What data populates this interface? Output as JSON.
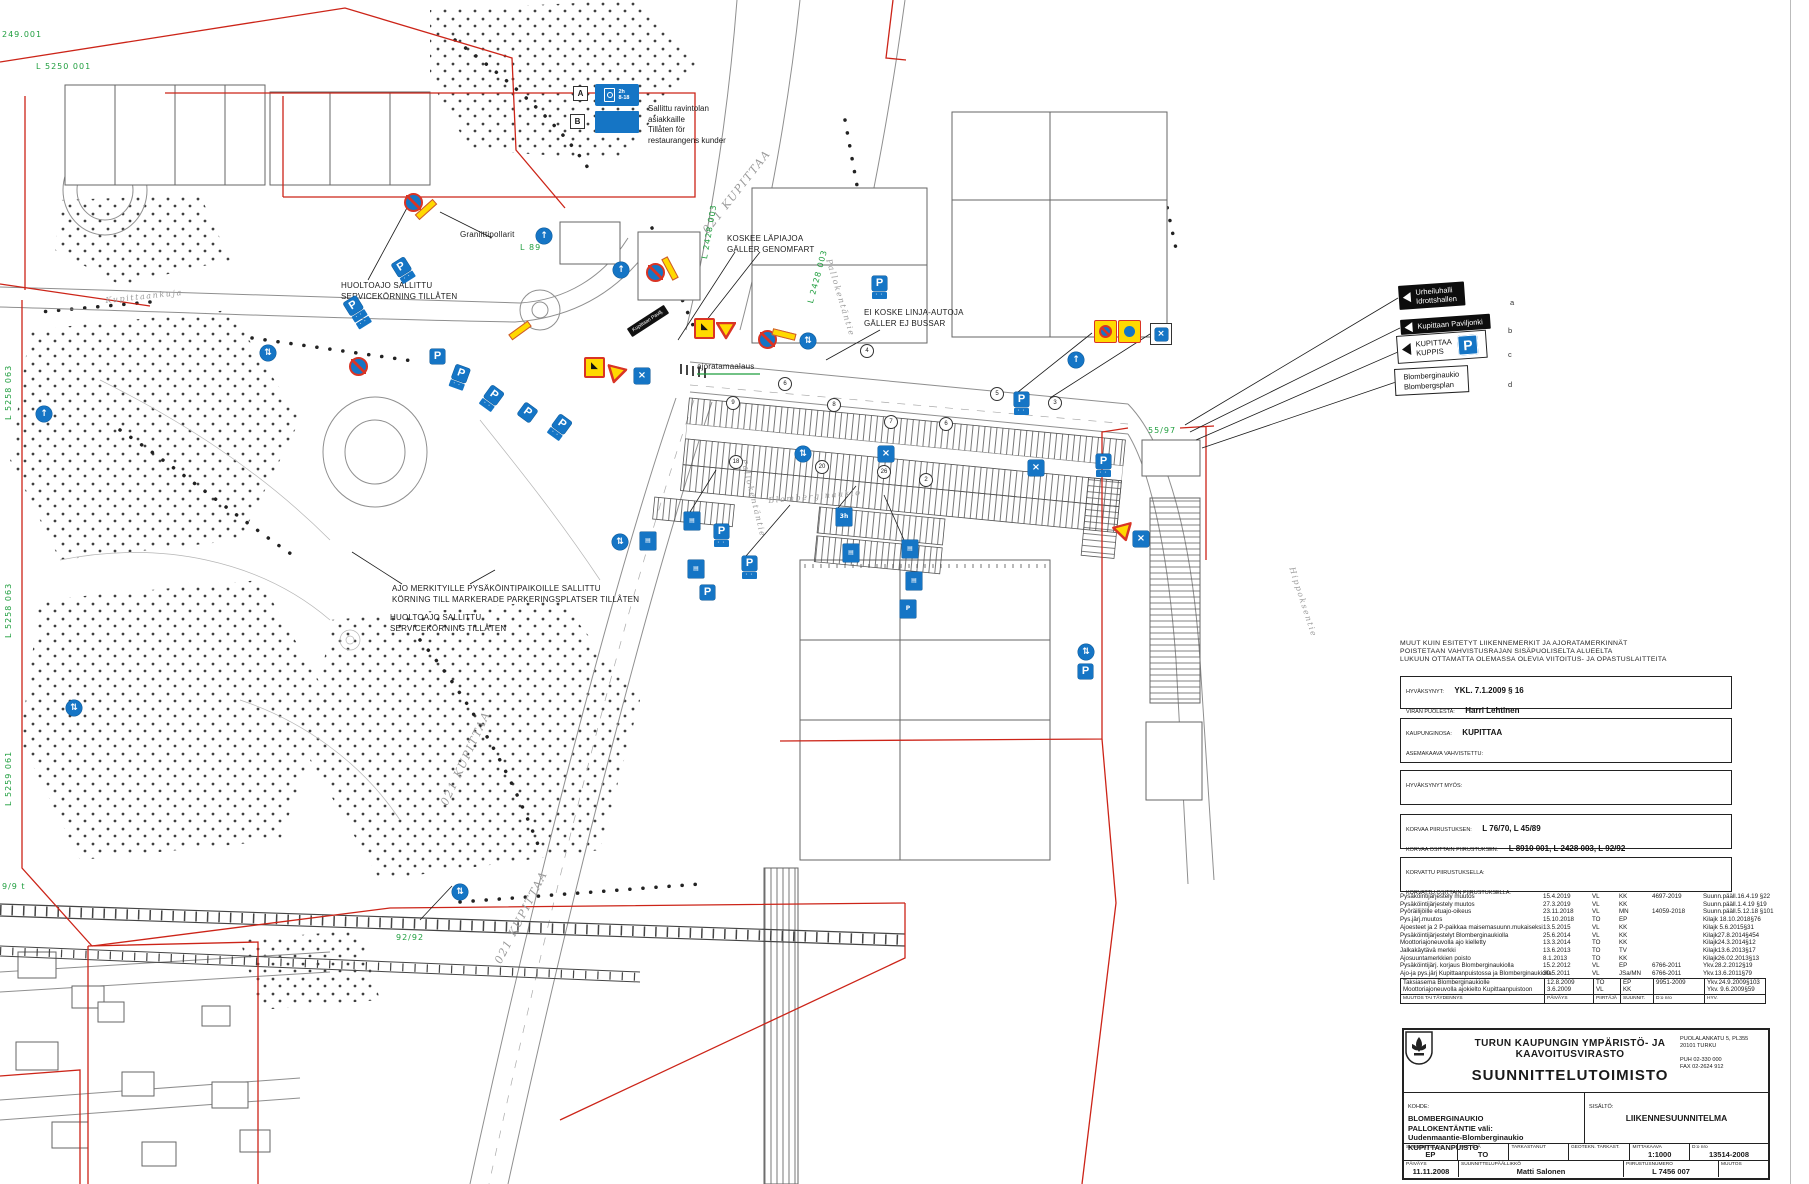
{
  "legend": {
    "a_letter": "A",
    "a_line1": "2h",
    "a_line2": "8-18",
    "b_letter": "B",
    "text": "Sallittu ravintolan\nasiakkaille\nTillåten för\nrestaurangens kunder"
  },
  "map": {
    "annotations": [
      {
        "text": "HUOLTOAJO SALLITTU\nSERVICEKÖRNING TILLÅTEN",
        "x": 341,
        "y": 281
      },
      {
        "text": "Graniittipollarit",
        "x": 460,
        "y": 230
      },
      {
        "text": "KOSKEE LÄPIAJOA\nGÄLLER GENOMFART",
        "x": 727,
        "y": 234
      },
      {
        "text": "EI KOSKE LINJA-AUTOJA\nGÄLLER EJ BUSSAR",
        "x": 864,
        "y": 308
      },
      {
        "text": "ajoratamaalaus",
        "x": 697,
        "y": 362
      },
      {
        "text": "AJO MERKITYILLE PYSÄKÖINTIPAIKOILLE SALLITTU\nKÖRNING TILL MARKERADE PARKERINGSPLATSER TILLÅTEN",
        "x": 392,
        "y": 584
      },
      {
        "text": "HUOLTOAJO SALLITTU\nSERVICEKÖRNING TILLÅTEN",
        "x": 390,
        "y": 613
      }
    ],
    "street_labels": [
      {
        "text": "Kupittaankuja",
        "x": 105,
        "y": 296,
        "r": -6,
        "s": 8
      },
      {
        "text": "021 KUPITTAA",
        "x": 700,
        "y": 228,
        "r": -52,
        "s": 11
      },
      {
        "text": "021 KUPITTAA",
        "x": 438,
        "y": 802,
        "r": -65,
        "s": 11
      },
      {
        "text": "021 KUPITTAA",
        "x": 492,
        "y": 960,
        "r": -63,
        "s": 11
      },
      {
        "text": "Pallokentäntie",
        "x": 833,
        "y": 258,
        "r": 73,
        "s": 8
      },
      {
        "text": "Pallokentäntie",
        "x": 748,
        "y": 458,
        "r": 76,
        "s": 8
      },
      {
        "text": "Blomberginaukio",
        "x": 768,
        "y": 496,
        "r": -5,
        "s": 8
      },
      {
        "text": "Hippoksentie",
        "x": 1296,
        "y": 566,
        "r": 72,
        "s": 8
      }
    ],
    "green_refs": [
      {
        "text": "249.001",
        "x": 2,
        "y": 30,
        "r": 0
      },
      {
        "text": "L 5250 001",
        "x": 36,
        "y": 62,
        "r": 0
      },
      {
        "text": "L 5258 063",
        "x": 4,
        "y": 420,
        "r": -90
      },
      {
        "text": "L 5258 063",
        "x": 4,
        "y": 638,
        "r": -90
      },
      {
        "text": "L 5259 061",
        "x": 4,
        "y": 806,
        "r": -90
      },
      {
        "text": "9/9 t",
        "x": 2,
        "y": 882,
        "r": 0
      },
      {
        "text": "92/92",
        "x": 396,
        "y": 933,
        "r": 0
      },
      {
        "text": "55/97",
        "x": 1148,
        "y": 426,
        "r": 0
      },
      {
        "text": "L 2428 003",
        "x": 806,
        "y": 302,
        "r": -75
      },
      {
        "text": "L 2428 003",
        "x": 700,
        "y": 258,
        "r": -80
      },
      {
        "text": "L 89",
        "x": 520,
        "y": 243,
        "r": 0
      }
    ],
    "waypoints": [
      {
        "n": "9",
        "x": 726,
        "y": 396
      },
      {
        "n": "6",
        "x": 778,
        "y": 377
      },
      {
        "n": "8",
        "x": 827,
        "y": 398
      },
      {
        "n": "7",
        "x": 884,
        "y": 415
      },
      {
        "n": "6",
        "x": 939,
        "y": 417
      },
      {
        "n": "5",
        "x": 990,
        "y": 387
      },
      {
        "n": "20",
        "x": 815,
        "y": 460
      },
      {
        "n": "26",
        "x": 877,
        "y": 465
      },
      {
        "n": "2",
        "x": 919,
        "y": 473
      },
      {
        "n": "18",
        "x": 729,
        "y": 455
      },
      {
        "n": "4",
        "x": 860,
        "y": 344
      },
      {
        "n": "3",
        "x": 1048,
        "y": 396
      }
    ],
    "signs": [
      {
        "t": "nostop",
        "x": 404,
        "y": 193,
        "r": 0
      },
      {
        "t": "bar",
        "x": 414,
        "y": 206,
        "r": -42
      },
      {
        "t": "nostop",
        "x": 349,
        "y": 357,
        "r": 0
      },
      {
        "t": "bar",
        "x": 508,
        "y": 327,
        "r": -36
      },
      {
        "t": "P",
        "x": 350,
        "y": 297,
        "r": -32,
        "p": 2
      },
      {
        "t": "P",
        "x": 396,
        "y": 259,
        "r": -32,
        "p": 1
      },
      {
        "t": "circ",
        "x": 260,
        "y": 345,
        "r": 0,
        "g": "⇅"
      },
      {
        "t": "circ",
        "x": 66,
        "y": 700,
        "r": 0,
        "g": "⇅"
      },
      {
        "t": "circ",
        "x": 36,
        "y": 406,
        "r": 0,
        "g": "↑"
      },
      {
        "t": "P",
        "x": 430,
        "y": 349,
        "r": 0,
        "p": 0
      },
      {
        "t": "P",
        "x": 452,
        "y": 366,
        "r": 20,
        "p": 1
      },
      {
        "t": "P",
        "x": 484,
        "y": 387,
        "r": 36,
        "p": 1
      },
      {
        "t": "P",
        "x": 520,
        "y": 405,
        "r": 36,
        "p": 0
      },
      {
        "t": "P",
        "x": 552,
        "y": 416,
        "r": 36,
        "p": 1
      },
      {
        "t": "circ",
        "x": 536,
        "y": 228,
        "r": 0,
        "g": "↑"
      },
      {
        "t": "circ",
        "x": 613,
        "y": 262,
        "r": 0,
        "g": "↑"
      },
      {
        "t": "blacksign",
        "x": 626,
        "y": 316,
        "r": -33,
        "txt": "Kupittaan Pavilj."
      },
      {
        "t": "work",
        "x": 584,
        "y": 357,
        "r": 0
      },
      {
        "t": "gw",
        "x": 608,
        "y": 364,
        "r": 14
      },
      {
        "t": "X",
        "x": 634,
        "y": 368,
        "r": 0
      },
      {
        "t": "work",
        "x": 694,
        "y": 318,
        "r": 0
      },
      {
        "t": "gw",
        "x": 716,
        "y": 322,
        "r": 0
      },
      {
        "t": "nostop",
        "x": 646,
        "y": 263,
        "r": 0
      },
      {
        "t": "bar",
        "x": 658,
        "y": 265,
        "r": 62
      },
      {
        "t": "nostop",
        "x": 758,
        "y": 330,
        "r": 0
      },
      {
        "t": "bar",
        "x": 772,
        "y": 331,
        "r": 14
      },
      {
        "t": "circ",
        "x": 800,
        "y": 333,
        "r": 0,
        "g": "⇅"
      },
      {
        "t": "P",
        "x": 872,
        "y": 276,
        "r": 0,
        "p": 1
      },
      {
        "t": "circ",
        "x": 795,
        "y": 446,
        "r": 0,
        "g": "⇅"
      },
      {
        "t": "X",
        "x": 878,
        "y": 446,
        "r": 0
      },
      {
        "t": "P",
        "x": 1014,
        "y": 392,
        "r": 0,
        "p": 1
      },
      {
        "t": "X",
        "x": 1028,
        "y": 460,
        "r": 0
      },
      {
        "t": "yb-nostop",
        "x": 1094,
        "y": 320,
        "r": 0
      },
      {
        "t": "yb-circ",
        "x": 1118,
        "y": 320,
        "r": 0
      },
      {
        "t": "Xo",
        "x": 1150,
        "y": 323,
        "r": 0
      },
      {
        "t": "circ",
        "x": 1068,
        "y": 352,
        "r": 0,
        "g": "↑"
      },
      {
        "t": "P",
        "x": 1096,
        "y": 454,
        "r": 0,
        "p": 1
      },
      {
        "t": "gw",
        "x": 1112,
        "y": 527,
        "r": -15
      },
      {
        "t": "X",
        "x": 1133,
        "y": 531,
        "r": 0
      },
      {
        "t": "circ",
        "x": 1078,
        "y": 644,
        "r": 0,
        "g": "⇅"
      },
      {
        "t": "P",
        "x": 1078,
        "y": 664,
        "r": 0,
        "p": 0
      },
      {
        "t": "info",
        "x": 684,
        "y": 512,
        "r": 0,
        "txt": "▤"
      },
      {
        "t": "P",
        "x": 714,
        "y": 524,
        "r": 0,
        "p": 1
      },
      {
        "t": "info",
        "x": 640,
        "y": 532,
        "r": 0,
        "txt": "▤"
      },
      {
        "t": "circ",
        "x": 612,
        "y": 534,
        "r": 0,
        "g": "⇅"
      },
      {
        "t": "P",
        "x": 742,
        "y": 556,
        "r": 0,
        "p": 1
      },
      {
        "t": "info",
        "x": 688,
        "y": 560,
        "r": 0,
        "txt": "▤"
      },
      {
        "t": "P",
        "x": 700,
        "y": 585,
        "r": 0,
        "p": 0
      },
      {
        "t": "info",
        "x": 836,
        "y": 508,
        "r": 0,
        "txt": "3h"
      },
      {
        "t": "info",
        "x": 843,
        "y": 544,
        "r": 0,
        "txt": "▤"
      },
      {
        "t": "info",
        "x": 902,
        "y": 540,
        "r": 0,
        "txt": "▤"
      },
      {
        "t": "info",
        "x": 906,
        "y": 572,
        "r": 0,
        "txt": "▤"
      },
      {
        "t": "info",
        "x": 900,
        "y": 600,
        "r": 0,
        "txt": "P"
      },
      {
        "t": "circ",
        "x": 452,
        "y": 884,
        "r": 0,
        "g": "⇅"
      }
    ],
    "direction_signs": [
      {
        "letter": "a",
        "style": "black",
        "lines": [
          "Urheiluhalli",
          "Idrottshallen"
        ],
        "x": 1398,
        "y": 286,
        "r": -4,
        "lx": 1510,
        "ly": 298
      },
      {
        "letter": "b",
        "style": "black",
        "lines": [
          "Kupittaan Paviljonki"
        ],
        "x": 1400,
        "y": 320,
        "r": -4,
        "lx": 1508,
        "ly": 326
      },
      {
        "letter": "c",
        "style": "white-p",
        "lines": [
          "KUPITTAA",
          "KUPPIS"
        ],
        "x": 1396,
        "y": 336,
        "r": -4,
        "lx": 1508,
        "ly": 350
      },
      {
        "letter": "d",
        "style": "white",
        "lines": [
          "Blomberginaukio",
          "Blombergsplan"
        ],
        "x": 1394,
        "y": 369,
        "r": -3,
        "lx": 1508,
        "ly": 380
      }
    ]
  },
  "notes": {
    "line1": "MUUT KUIN ESITETYT LIIKENNEMERKIT JA AJORATAMERKINNÄT",
    "line2": "POISTETAAN VAHVISTUSRAJAN SISÄPUOLISELTA ALUEELTA",
    "line3": "LUKUUN OTTAMATTA OLEMASSA OLEVIA VIITOITUS- JA OPASTUSLAITTEITA"
  },
  "boxes": {
    "approved_label": "HYVÄKSYNYT:",
    "approved_value": "YKL. 7.1.2009 § 16",
    "behalf_label": "VIRAN PUOLESTA:",
    "behalf_value": "Harri Lehtinen",
    "district_label": "KAUPUNGINOSA:",
    "district_value": "KUPITTAA",
    "plan_label": "ASEMAKAAVA VAHVISTETTU:",
    "street_class_label": "KATULUOKKA:",
    "also_approved_label": "HYVÄKSYNYT MYÖS:",
    "replaces_label": "KORVAA PIIRUSTUKSEN:",
    "replaces_value": "L 76/70, L 45/89",
    "replaces_part_label": "KORVAA OSITTAIN PIIRUSTUKSEN:",
    "replaces_part_value": "L 8910 001, L 2428 003, L 92/92",
    "replaced_by_label": "KORVATTU PIIRUSTUKSELLA:",
    "replaced_part_label": "KORVATTU OSITTAIN PIIRUSTUKSELLA:"
  },
  "revisions": {
    "rows": [
      [
        "Pysäköintijärjestely muutos",
        "15.4.2019",
        "VL",
        "KK",
        "4697-2019",
        "Suunn.pääll.16.4.19 §22"
      ],
      [
        "Pysäköintijärjestely muutos",
        "27.3.2019",
        "VL",
        "KK",
        "",
        "Suunn.pääll.1.4.19 §19"
      ],
      [
        "Pyöräilijöille etuajo-oikeus",
        "23.11.2018",
        "VL",
        "MN",
        "14059-2018",
        "Suunn.pääll.5.12.18 §101"
      ],
      [
        "Pys.järj.muutos",
        "15.10.2018",
        "TO",
        "EP",
        "",
        "Kilajk 18.10.2018§76"
      ],
      [
        "Ajoesteet ja 2 P-paikkaa maisemasuunn.mukaiseksi",
        "13.5.2015",
        "VL",
        "KK",
        "",
        "Kilajk 5.6.2015§31"
      ],
      [
        "Pysäköintijärjestelyt Blomberginaukiolla",
        "25.6.2014",
        "VL",
        "KK",
        "",
        "Kilajk27.8.2014§454"
      ],
      [
        "Moottoriajoneuvolla ajo kielletty",
        "13.3.2014",
        "TO",
        "KK",
        "",
        "Kilajk24.3.2014§12"
      ],
      [
        "Jalkakäytävä merkki",
        "13.6.2013",
        "TO",
        "TV",
        "",
        "Kilajk13.6.2013§17"
      ],
      [
        "Ajosuuntamerkkien poisto",
        "8.1.2013",
        "TO",
        "KK",
        "",
        "Kilajk26.02.2013§13"
      ],
      [
        "Pysäköintijärj. korjaus Blomberginaukiolla",
        "15.2.2012",
        "VL",
        "EP",
        "6766-2011",
        "Ykv.28.2.2012§19"
      ],
      [
        "Ajo-ja pys.järj Kupittaanpuistossa ja Blomberginaukiolla",
        "30.5.2011",
        "VL",
        "JSa/MN",
        "6766-2011",
        "Ykv.13.6.2011§79"
      ],
      [
        "Taksiasema Blomberginaukiolle",
        "12.8.2009",
        "TO",
        "EP",
        "9951-2009",
        "Ykv.24.9.2009§103"
      ],
      [
        "Moottoriajoneuvolla ajokielto Kupittaanpuistoon",
        "3.6.2009",
        "VL",
        "KK",
        "",
        "Ykv. 9.6.2009§59"
      ]
    ],
    "footer": [
      "MUUTOS TAI TÄYDENNYS",
      "PÄIVÄYS",
      "PIIRTÄJÄ",
      "SUUNNIT.",
      "D:o nro",
      "HYV."
    ]
  },
  "title_block": {
    "org": "TURUN KAUPUNGIN YMPÄRISTÖ- JA KAAVOITUSVIRASTO",
    "office": "SUUNNITTELUTOIMISTO",
    "address": "PUOLALANKATU 5, PL355\n20101 TURKU\n\nPUH 02-330 000\nFAX 02-2624 912",
    "kohde_label": "KOHDE:",
    "kohde": "BLOMBERGINAUKIO\nPALLOKENTÄNTIE väli:\nUudenmaantie-Blomberginaukio\nKUPITTAANPUISTO",
    "sisalto_label": "SISÄLTÖ:",
    "sisalto": "LIIKENNESUUNNITELMA",
    "cells": [
      {
        "l": "SUUNNITTELIJA",
        "v": "EP"
      },
      {
        "l": "PIIRTÄJÄ",
        "v": "TO"
      },
      {
        "l": "TARKASTANUT",
        "v": ""
      },
      {
        "l": "GEOTEKN. TARKAST.",
        "v": ""
      },
      {
        "l": "MITTAKAAVA",
        "v": "1:1000"
      },
      {
        "l": "D:o nro",
        "v": "13514-2008"
      }
    ],
    "cells2": [
      {
        "l": "PÄIVÄYS",
        "v": "11.11.2008"
      },
      {
        "l": "SUUNNITTELUPÄÄLLIKKÖ",
        "v": "Matti Salonen"
      },
      {
        "l": "PIIRUSTUSNUMERO",
        "v": "L 7456 007"
      },
      {
        "l": "MUUTOS",
        "v": ""
      }
    ]
  }
}
